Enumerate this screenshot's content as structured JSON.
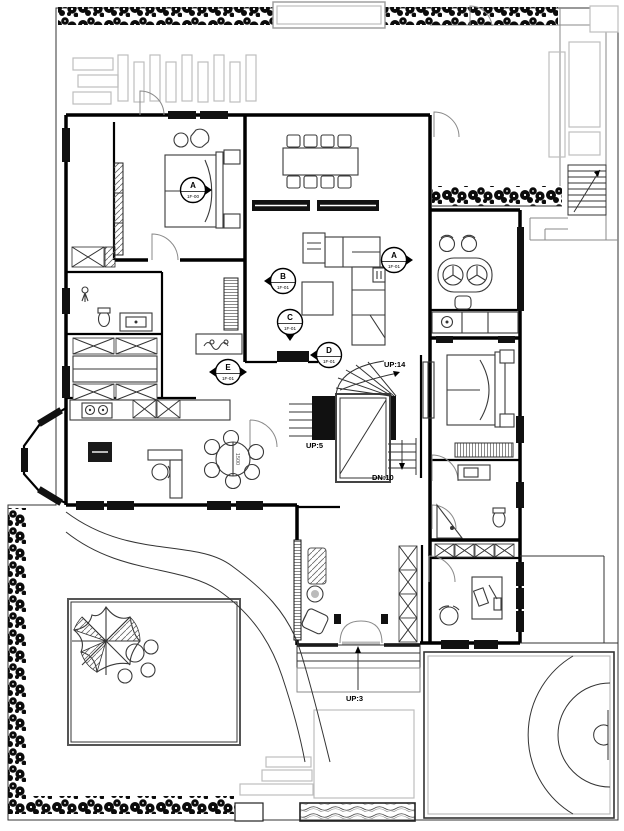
{
  "plan": {
    "stair_labels": {
      "main_up": "UP:14",
      "entry_up": "UP:5",
      "main_down": "DN:10",
      "porch_up": "UP:3"
    },
    "dimension_labels": {
      "breakfast_table": "1500"
    },
    "elevation_markers": [
      {
        "letter": "A",
        "sheet": "1F-00"
      },
      {
        "letter": "A",
        "sheet": "1F-01"
      },
      {
        "letter": "B",
        "sheet": "1F-01"
      },
      {
        "letter": "C",
        "sheet": "1F-01"
      },
      {
        "letter": "D",
        "sheet": "1F-01"
      },
      {
        "letter": "E",
        "sheet": "1F-01"
      }
    ],
    "colors": {
      "walls": "#000000",
      "furniture": "#3a3a3a",
      "outdoor": "#bdbdbd",
      "hedge": "#0b0b0b",
      "paper": "#ffffff"
    }
  }
}
